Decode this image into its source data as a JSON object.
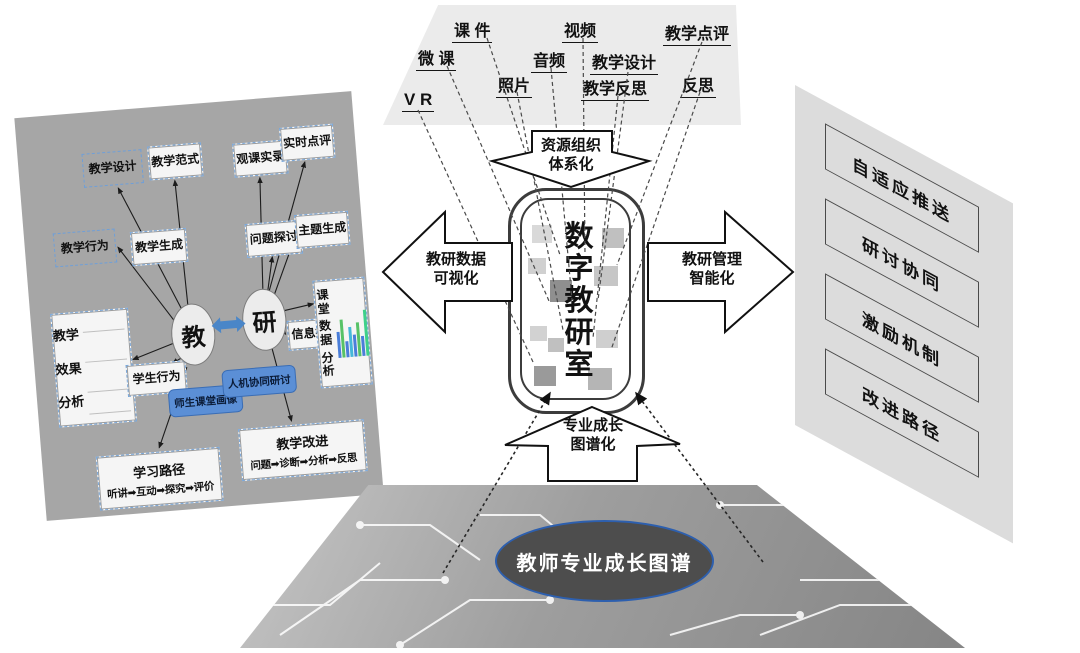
{
  "top_panel": {
    "resources": [
      "课 件",
      "视频",
      "教学点评",
      "微 课",
      "音频",
      "教学设计",
      "照片",
      "教学反思",
      "反思",
      "V R"
    ]
  },
  "center": {
    "device_label": "数字教研室"
  },
  "big_arrows": {
    "top": {
      "line1": "资源组织",
      "line2": "体系化"
    },
    "left": {
      "line1": "教研数据",
      "line2": "可视化"
    },
    "right": {
      "line1": "教研管理",
      "line2": "智能化"
    },
    "bottom": {
      "line1": "专业成长",
      "line2": "图谱化"
    }
  },
  "left_panel": {
    "nodes": {
      "jiaoxue_sheji": "教学设计",
      "jiaoxue_fanshi": "教学范式",
      "guanke_shilu": "观课实录",
      "shishi_dianping": "实时点评",
      "jiaoxue_xingwei": "教学行为",
      "jiaoxue_shengcheng": "教学生成",
      "wenti_tantao": "问题探讨",
      "zhuti_shengcheng": "主题生成",
      "jiao": "教",
      "yan": "研",
      "xuesheng_xingwei": "学生行为",
      "xinxi_tiqu": "信息提取",
      "shisheng_huaxiang": "师生课堂画像",
      "renji_yantao": "人机协同研讨"
    },
    "effect_chart": {
      "l1": "教学",
      "l2": "效果",
      "l3": "分析"
    },
    "class_data_chart": {
      "l1": "课堂",
      "l2": "数据",
      "l3": "分析"
    },
    "bar_chart": {
      "bars": [
        {
          "h": 26,
          "color": "#4a7ed9"
        },
        {
          "h": 38,
          "color": "#57c267"
        },
        {
          "h": 16,
          "color": "#4a7ed9"
        },
        {
          "h": 30,
          "color": "#45b8d9"
        },
        {
          "h": 22,
          "color": "#4a7ed9"
        },
        {
          "h": 34,
          "color": "#57c267"
        },
        {
          "h": 20,
          "color": "#4a7ed9"
        },
        {
          "h": 46,
          "color": "#3fd08a"
        }
      ]
    },
    "learning_path": {
      "title": "学习路径",
      "flow": "听讲➡互动➡探究➡评价"
    },
    "teaching_improve": {
      "title": "教学改进",
      "flow": "问题➡诊断➡分析➡反思"
    }
  },
  "right_panel": {
    "items": [
      "自适应推送",
      "研讨协同",
      "激励机制",
      "改进路径"
    ]
  },
  "bottom": {
    "ellipse_label": "教师专业成长图谱"
  },
  "colors": {
    "left_panel_bg": "#a6a6a6",
    "right_panel_bg": "#dcdcdc",
    "top_panel_bg": "#ebebeb",
    "node_blue_fill": "#5b8fd6",
    "link_blue": "#4a86c8",
    "board_ellipse_border": "#2d5fae"
  }
}
